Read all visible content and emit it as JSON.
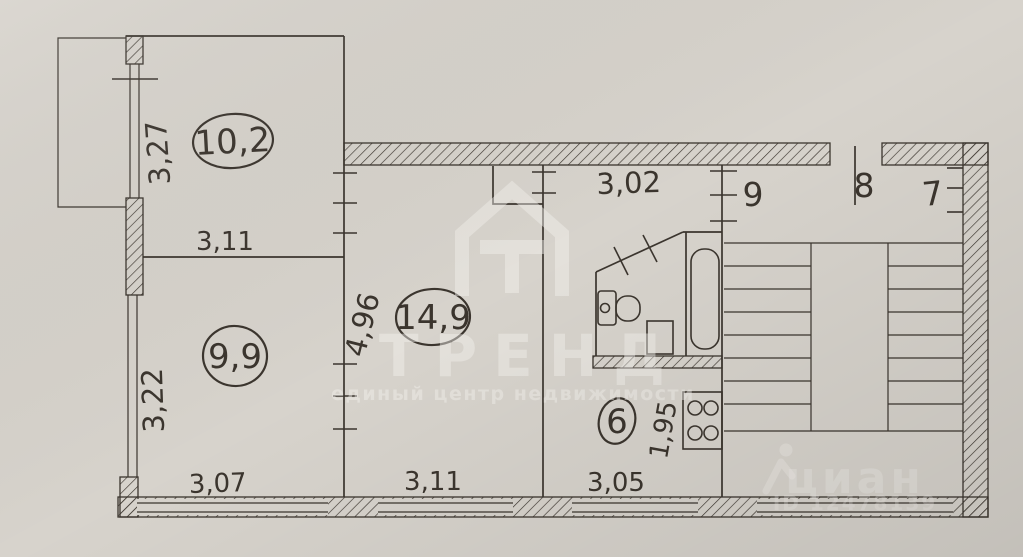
{
  "plan": {
    "rooms": {
      "living1": {
        "area": "10,2",
        "side": "3,27",
        "bottom": "3,11"
      },
      "living2": {
        "area": "9,9",
        "side": "3,22",
        "bottom": "3,07"
      },
      "living3": {
        "area": "14,9",
        "side": "4,96",
        "bottom": "3,11"
      },
      "hallway": {
        "top": "3,02"
      },
      "kitchen": {
        "area": "6",
        "side": "1,95",
        "bottom": "3,05"
      }
    },
    "common_areas": {
      "label9": "9",
      "label8": "8",
      "label7": "7"
    }
  },
  "watermarks": {
    "trend": {
      "brand": "ТРЕНД",
      "tagline": "единый центр недвижимости"
    },
    "cian": {
      "brand": "циан",
      "listing_id": "ID 12478139"
    }
  },
  "colors": {
    "paper": "#d7d3cc",
    "paper-dark": "#c5c1ba",
    "ink": "#3b352e",
    "watermark": "#f4f2ee"
  }
}
